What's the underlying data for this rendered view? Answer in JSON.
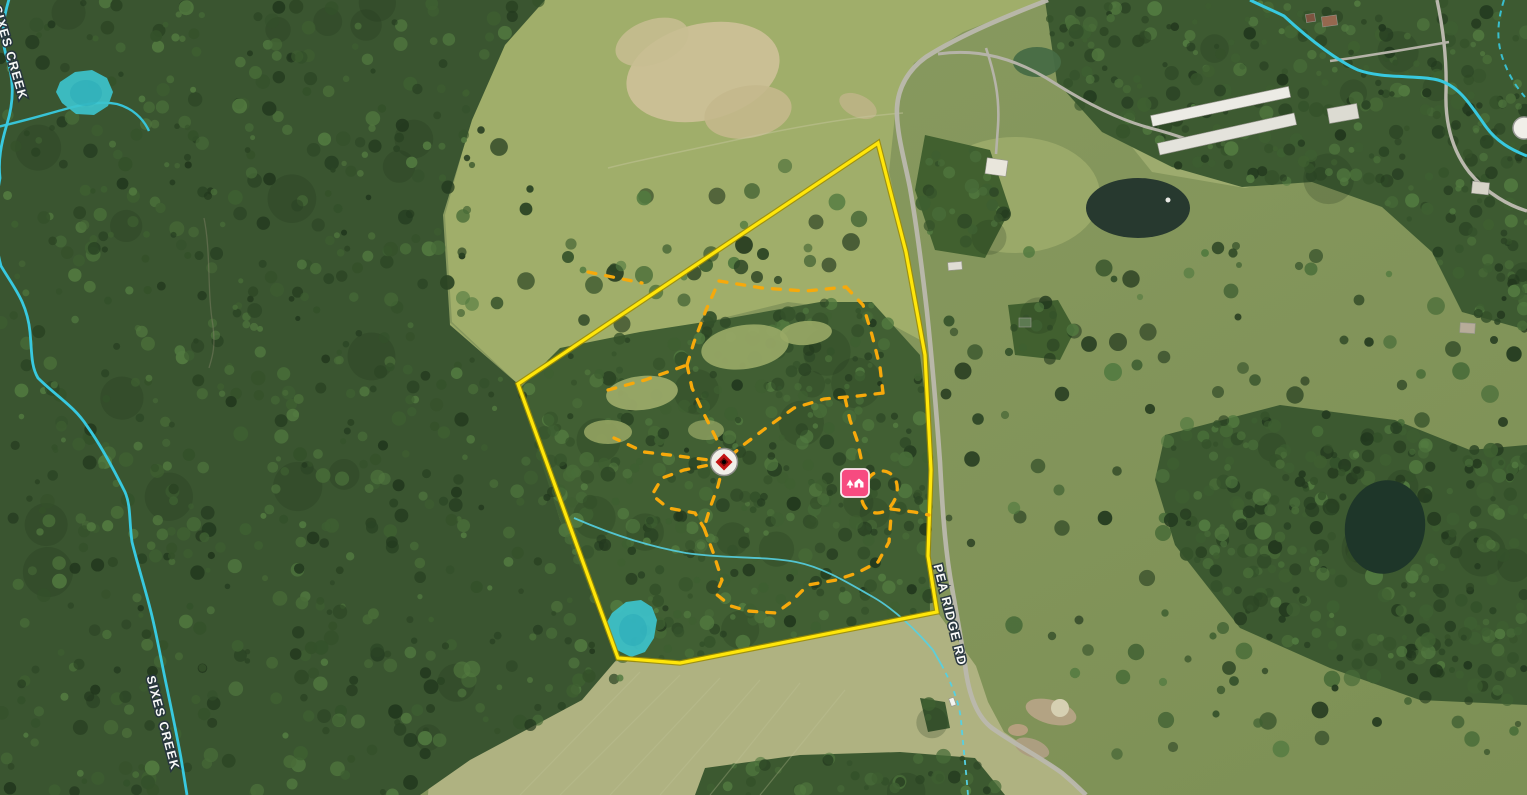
{
  "map": {
    "view": "satellite-aerial",
    "labels": {
      "road": "PEA RIDGE RD",
      "creek_upper": "SIXES CREEK",
      "creek_lower": "SIXES CREEK"
    },
    "overlays": {
      "property_boundary": {
        "color": "#ffe60a",
        "style": "solid"
      },
      "trail_network": {
        "color": "#f7a90b",
        "style": "dashed"
      },
      "streams": {
        "color": "#38c9df",
        "styles": [
          "solid",
          "dashed-intermittent"
        ]
      },
      "pond_highlight_color": "#3dc3cc",
      "pond_count_highlighted": 2
    },
    "markers": [
      {
        "name": "trail-hub-marker",
        "icon": "red-diamond-waypoint-icon",
        "fill": "#c41414",
        "ring": "#f1efe9"
      },
      {
        "name": "cabin-marker",
        "icon": "cabin-with-tree-icon",
        "fill": "#f74b80"
      },
      {
        "name": "edge-partial-marker",
        "icon": "white-circle-marker",
        "fill": "#f1efe9"
      }
    ],
    "imagery_features": [
      "forest",
      "pasture",
      "hay-fields",
      "farm-ponds",
      "poultry-barns",
      "gravel-roads"
    ]
  }
}
